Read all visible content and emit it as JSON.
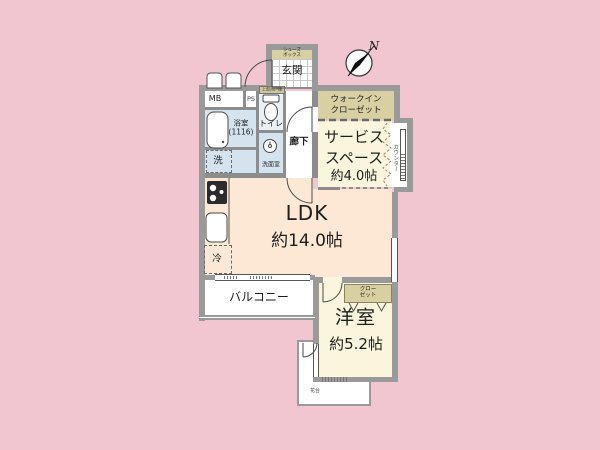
{
  "plan_title": "1LDK floor plan",
  "compass": {
    "north": "N"
  },
  "rooms": {
    "ldk": {
      "name": "LDK",
      "size": "約14.0帖"
    },
    "service": {
      "line1": "サービス",
      "line2": "スペース",
      "size": "約4.0帖"
    },
    "western": {
      "name": "洋室",
      "size": "約5.2帖"
    },
    "entrance": {
      "name": "玄関"
    },
    "hallway": {
      "name": "廊下"
    },
    "toilet": {
      "name": "トイレ"
    },
    "bathroom": {
      "name": "浴室",
      "size_note": "(1116)"
    },
    "washroom": {
      "name": "洗面室"
    },
    "balcony": {
      "name": "バルコニー"
    },
    "wic": {
      "line1": "ウォークイン",
      "line2": "クローゼット"
    },
    "closet": {
      "line1": "クロー",
      "line2": "ゼット"
    },
    "shoebox": {
      "line1": "シューズ",
      "line2": "ボックス"
    }
  },
  "fixtures": {
    "washer": "洗",
    "fridge": "冷",
    "counter": "カウンター",
    "flower_stand": "花台",
    "upper_cabinet": "上部吊戸棚"
  },
  "utilities": {
    "mb": "MB",
    "ps": "PS"
  },
  "colors": {
    "background": "#f1c6d1",
    "wall": "#9a9a9a",
    "ldk_fill": "#fce8d4",
    "tatami_fill": "#faf5dc",
    "closet_fill": "#d8cfa2",
    "wet_area_fill": "#d5e3ee",
    "toilet_fill": "#eaf1f6"
  }
}
